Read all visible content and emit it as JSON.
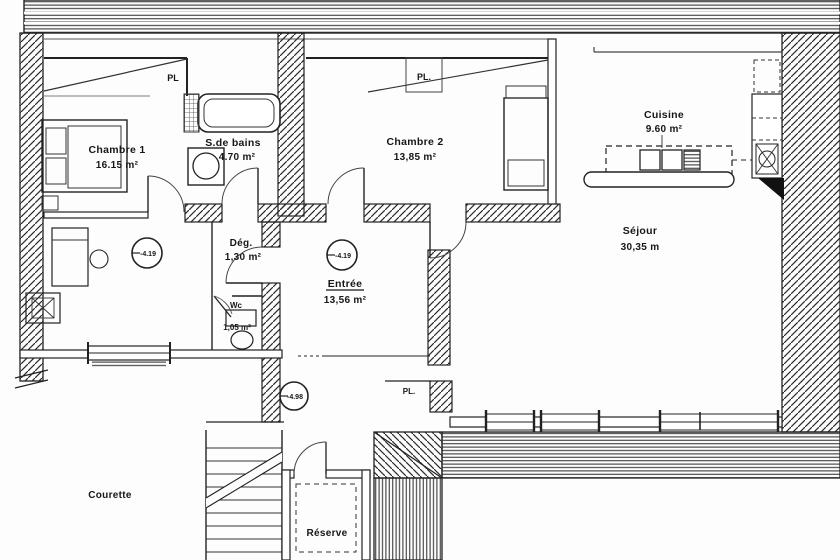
{
  "plan": {
    "title": "Apartment floor plan (scanned architectural drawing)",
    "rooms": {
      "chambre1": {
        "name": "Chambre 1",
        "area": "16.15 m²"
      },
      "sdb": {
        "name": "S.de bains",
        "area": "4.70 m²"
      },
      "chambre2": {
        "name": "Chambre 2",
        "area": "13,85 m²"
      },
      "cuisine": {
        "name": "Cuisine",
        "area": "9.60 m²"
      },
      "sejour": {
        "name": "Séjour",
        "area": "30,35 m"
      },
      "entree": {
        "name": "Entrée",
        "area": "13,56 m²"
      },
      "degagement": {
        "name": "Dég.",
        "area": "1,30 m²"
      },
      "wc": {
        "name": "Wc",
        "area": "1,05 m²"
      },
      "reserve": {
        "name": "Réserve"
      },
      "courette": {
        "name": "Courette"
      }
    },
    "closets": {
      "pl_chambre1": "PL",
      "pl_chambre2": "PL.",
      "pl_entree": "PL."
    },
    "levels": {
      "entree_left": "-4.19",
      "entree_main": "-4.19",
      "entree_low": "-4.98"
    },
    "colors": {
      "ink": "#1c1c1c",
      "paper": "#ffffff",
      "hatch": "#333333"
    }
  }
}
